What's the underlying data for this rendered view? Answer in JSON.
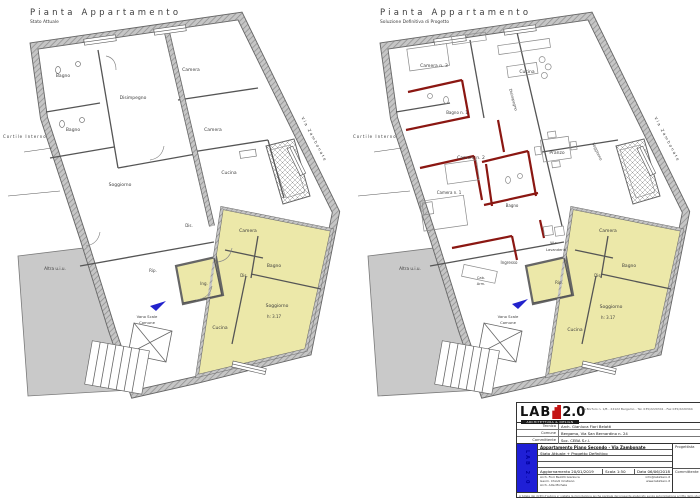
{
  "colors": {
    "wall_gray": "#9b9b9b",
    "apartment_yellow": "#ece8a9",
    "new_wall_red": "#8b1712",
    "entrance_blue": "#2222cc",
    "neighbor_gray": "#c9c9c9"
  },
  "left_plan": {
    "title": "Pianta Appartamento",
    "subtitle": "Stato Attuale",
    "rooms": [
      {
        "label": "Bagno"
      },
      {
        "label": "Bagno"
      },
      {
        "label": "Disimpegno"
      },
      {
        "label": "Camera"
      },
      {
        "label": "Camera"
      },
      {
        "label": "Cucina"
      },
      {
        "label": "Soggiorno"
      },
      {
        "label": "Dis."
      },
      {
        "label": "Camera"
      },
      {
        "label": "Bagno"
      },
      {
        "label": "Dis."
      },
      {
        "label": "Ing."
      },
      {
        "label": "Rip."
      },
      {
        "label": "Soggiorno"
      },
      {
        "label": "h: 3.17"
      },
      {
        "label": "Cucina"
      },
      {
        "label": "Vano Scale"
      },
      {
        "label": "Comune"
      },
      {
        "label": "Altra u.i.u."
      },
      {
        "label": "Cortile  Interno"
      },
      {
        "label": "Via  Zambonate"
      }
    ]
  },
  "right_plan": {
    "title": "Pianta Appartamento",
    "subtitle": "Soluzione Definitiva di Progetto",
    "rooms": [
      {
        "label": "Camera n. 3"
      },
      {
        "label": "Cucina"
      },
      {
        "label": "Bagno n. 1"
      },
      {
        "label": "Disimpegno"
      },
      {
        "label": "Camera n. 2"
      },
      {
        "label": "Pranzo"
      },
      {
        "label": "Soggiorno"
      },
      {
        "label": "Camera n. 1"
      },
      {
        "label": "Bagno"
      },
      {
        "label": "W.c."
      },
      {
        "label": "Lavanderia"
      },
      {
        "label": "Ingresso"
      },
      {
        "label": "Cab."
      },
      {
        "label": "Arm."
      },
      {
        "label": "Camera"
      },
      {
        "label": "Bagno"
      },
      {
        "label": "Dis."
      },
      {
        "label": "Rip."
      },
      {
        "label": "Soggiorno"
      },
      {
        "label": "h: 3.17"
      },
      {
        "label": "Cucina"
      },
      {
        "label": "Vano Scale"
      },
      {
        "label": "Comune"
      },
      {
        "label": "Altra u.i.u."
      },
      {
        "label": "Cortile  Interno"
      },
      {
        "label": "Via  Zambonate"
      }
    ]
  },
  "title_block": {
    "logo_lab": "LAB",
    "logo_version": "2.0",
    "logo_tagline": "ARCHITETTURA & DESIGN",
    "strip_text": "LAB 2.0",
    "address_line": "Via Borfuro n. 1/B - 24122 Bergamo - Tel. 035/2220341 - Fax 035/2220344",
    "info_rows": [
      {
        "label": "Tecnico",
        "value": "Arch. Gianluca Fiori Belotti"
      },
      {
        "label": "Comune",
        "value": "Bergamo, Via San Bernardino n. 24"
      },
      {
        "label": "Committente",
        "value": "Soc. CEBA S.r.l."
      }
    ],
    "project_title": "Appartamento Piano Secondo - Via Zambonate",
    "project_subtitle": "Stato Attuale + Progetto Definitivo",
    "update_label": "Aggiornamento",
    "update_value": "20/01/2019",
    "scale_label": "Scala",
    "scale_value": "1:50",
    "date_label": "Data",
    "date_value": "06/06/2018",
    "right_labels": [
      "Progettista",
      "Committente"
    ],
    "team": [
      "Arch. Fiori Belotti Gianluca",
      "Geom. Chiodi Cristiano",
      "Arch. Aita Michela"
    ],
    "contacts": [
      "info@lab2zero.it",
      "www.lab2zero.it"
    ],
    "legal": "A tutela dei diritti d'autore e' vietata la riproduzione anche parziale del presente elaborato senza autorizzazione scritta dello studio"
  }
}
